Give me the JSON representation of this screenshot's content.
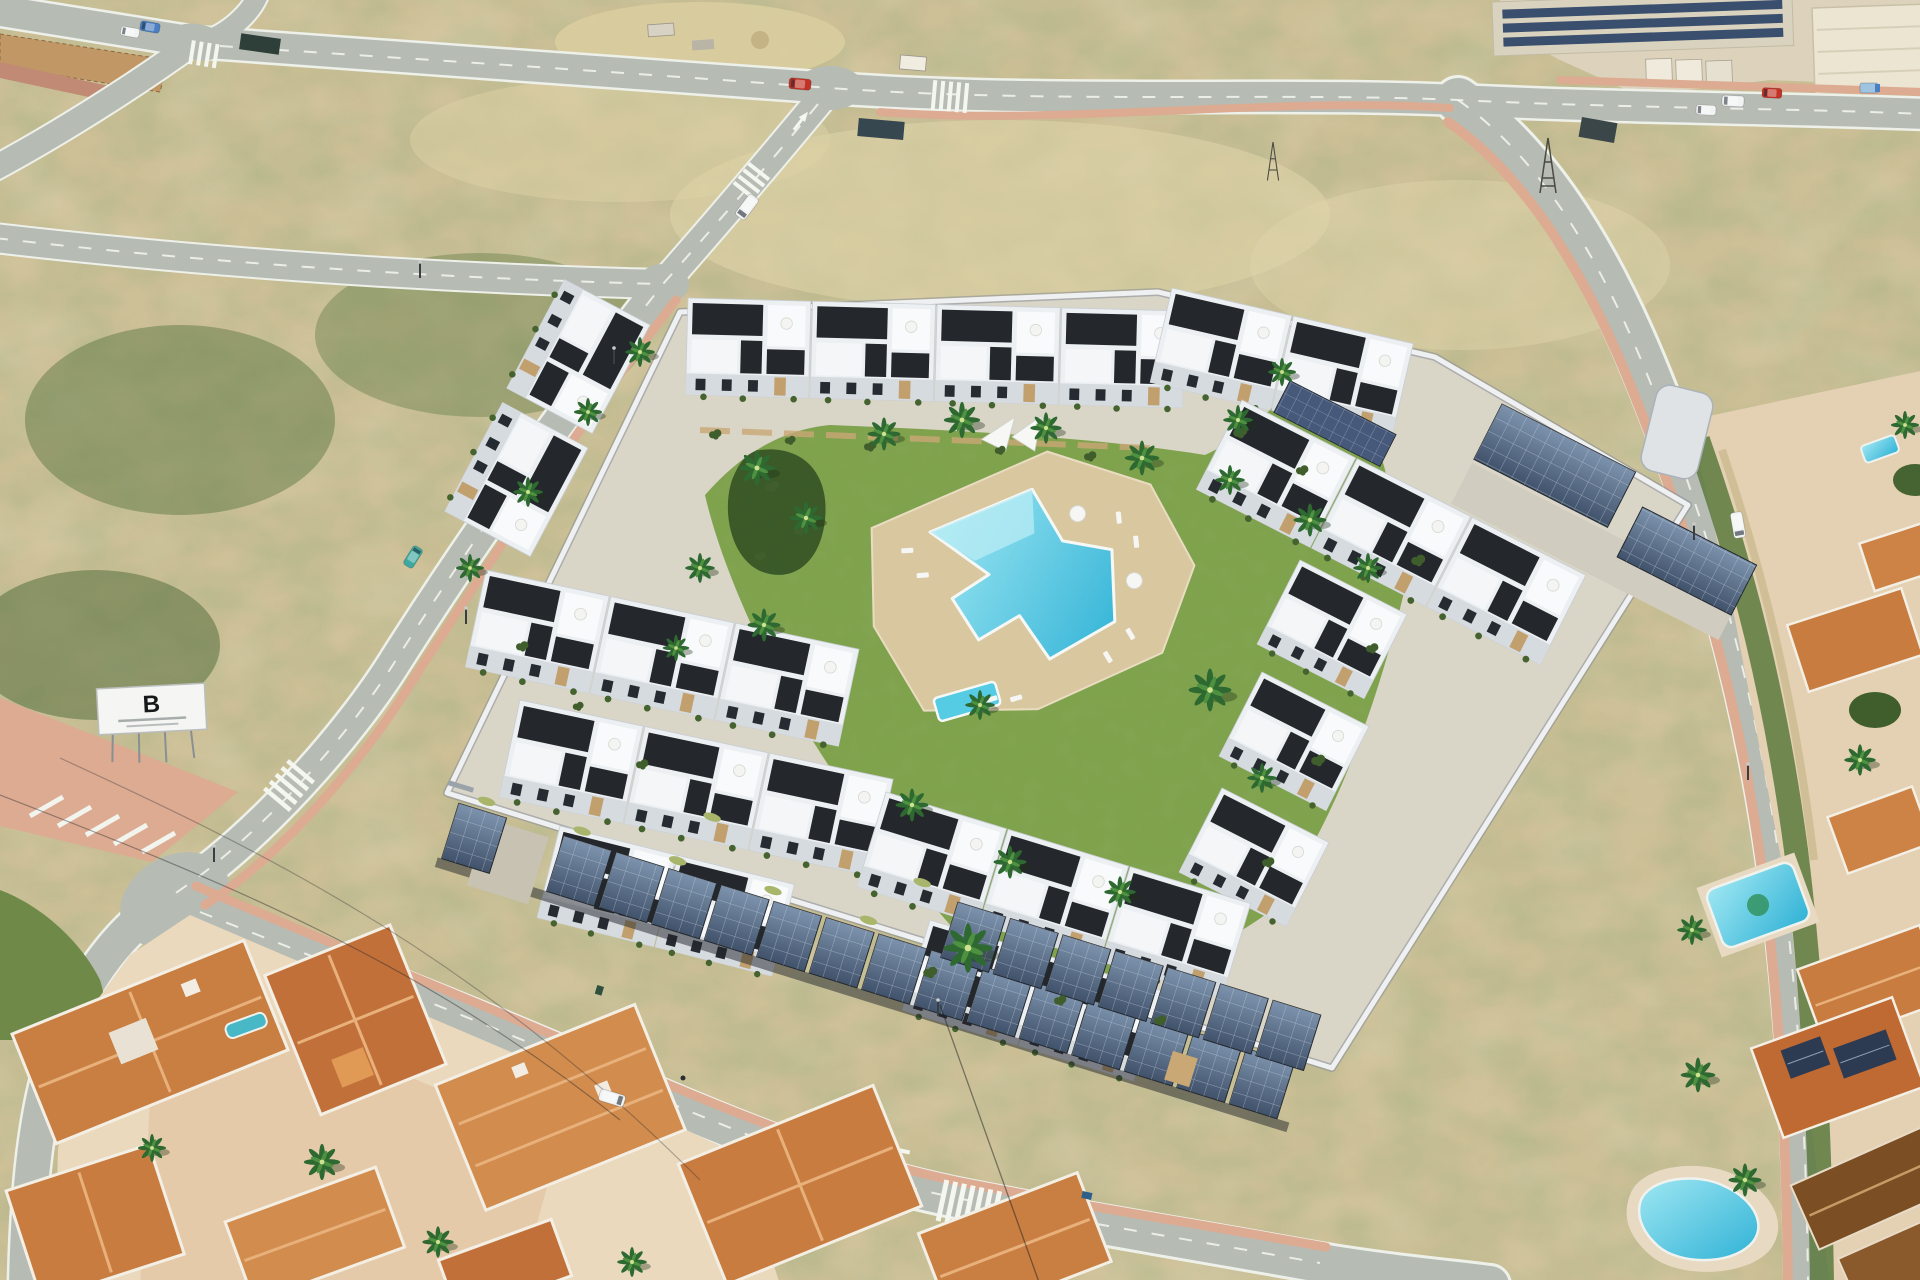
{
  "scene": {
    "description": "Sunny aerial 3D render of a walled new-build residential community of white modern townhouses around a communal lawn with free-form pool and photovoltaic carports, bordered by new roads, empty scrubland plots, industrial units at top right and an established terracotta-roofed neighbourhood at bottom left and right",
    "billboard_logo": "B"
  },
  "colors": {
    "scrub_sand": "#cdbf96",
    "scrub_green": "#5f7540",
    "road_asphalt": "#b6bbb4",
    "road_marking": "#f4f6f0",
    "sidewalk_pink": "#dcab92",
    "lawn_green": "#7fa24d",
    "palm_green": "#2d6930",
    "pool_blue": "#56cbe4",
    "pool_deck": "#d9c7a0",
    "building_white": "#ecf0f3",
    "building_dark": "#24282c",
    "stone_clad": "#c2a06e",
    "solar_panel": "#51647e",
    "terracotta_roof": "#c97e42",
    "brown_roof": "#7c4e24",
    "old_town_ground": "#ead9bd",
    "wall_white": "#eef0f2",
    "car_red": "#c23327",
    "car_teal": "#3fa8a0",
    "car_white": "#f2f4f4",
    "car_blue": "#4a7fc1"
  },
  "counts": {
    "townhouse_clusters": 6,
    "communal_pools": 2,
    "private_pools": 4,
    "solar_carport_bays": 22,
    "rooftop_solar_arrays": 4,
    "palm_trees": 34,
    "cars_visible": 11,
    "crosswalks": 5,
    "road_arrows": 3,
    "billboards": 1
  }
}
